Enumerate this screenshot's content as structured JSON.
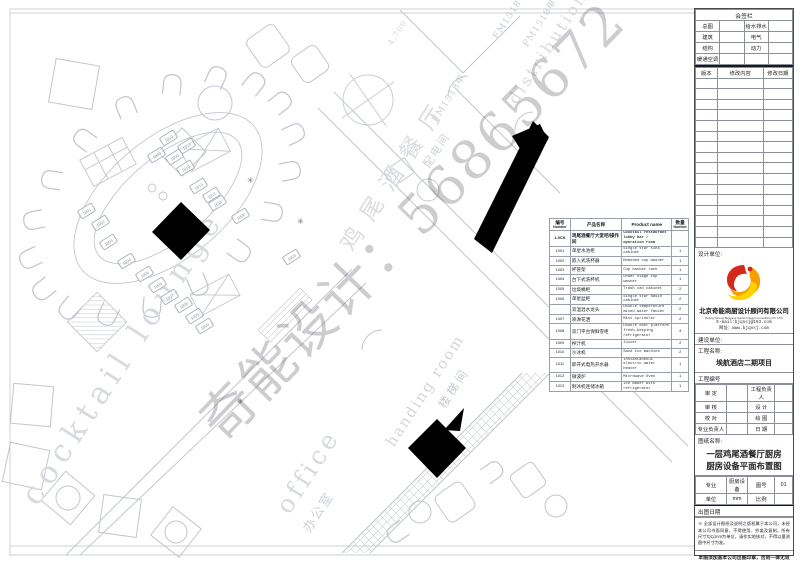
{
  "watermark": "奇能设计：56865672",
  "plan": {
    "texts": [
      {
        "id": "cocktail-lounge",
        "text": "cocktail lounge",
        "x": 14,
        "y": 492,
        "rot": -57,
        "size": 31,
        "ls": 7,
        "color": "#d7dade"
      },
      {
        "id": "lounge-cn",
        "text": "鸡尾酒餐厅",
        "x": 330,
        "y": 238,
        "rot": -57,
        "size": 23,
        "ls": 13,
        "color": "#dadce0"
      },
      {
        "id": "handing-room",
        "text": "handing room",
        "x": 382,
        "y": 440,
        "rot": -57,
        "size": 15,
        "ls": 2,
        "color": "#d3d6db"
      },
      {
        "id": "stair-cn",
        "text": "楼梯间",
        "x": 434,
        "y": 402,
        "rot": -57,
        "size": 12,
        "ls": 3,
        "color": "#c7ccd4"
      },
      {
        "id": "office-en",
        "text": "office",
        "x": 270,
        "y": 503,
        "rot": -57,
        "size": 25,
        "ls": 4,
        "color": "#d6d9dd"
      },
      {
        "id": "office-cn",
        "text": "办公室",
        "x": 297,
        "y": 525,
        "rot": -57,
        "size": 13,
        "ls": 2,
        "color": "#ced2d8"
      },
      {
        "id": "dist-cn",
        "text": "配电间",
        "x": 419,
        "y": 162,
        "rot": -57,
        "size": 11,
        "ls": 2,
        "color": "#ced2d8"
      },
      {
        "id": "dist-en",
        "text": "distribution",
        "x": 504,
        "y": 97,
        "rot": -57,
        "size": 16,
        "ls": 3,
        "color": "#d8dadf"
      },
      {
        "id": "door-tag-1",
        "text": "FM1518甲",
        "x": 428,
        "y": 117,
        "rot": -57,
        "size": 9,
        "ls": 1,
        "color": "#c9ced6"
      },
      {
        "id": "door-tag-2",
        "text": "FM1518甲",
        "x": 519,
        "y": 42,
        "rot": -57,
        "size": 9,
        "ls": 1,
        "color": "#c9ced6"
      },
      {
        "id": "door-tag-3",
        "text": "FM1518甲",
        "x": 489,
        "y": 34,
        "rot": -57,
        "size": 9,
        "ls": 1,
        "color": "#c9ced6"
      },
      {
        "id": "dim-4700",
        "text": "4,700",
        "x": 386,
        "y": 42,
        "rot": -57,
        "size": 8,
        "ls": 1,
        "color": "#d2d5da"
      }
    ],
    "tags": [
      {
        "n": "1010",
        "x": 160,
        "y": 133
      },
      {
        "n": "1013",
        "x": 178,
        "y": 141
      },
      {
        "n": "1009",
        "x": 148,
        "y": 150
      },
      {
        "n": "1009",
        "x": 166,
        "y": 152
      },
      {
        "n": "1010",
        "x": 177,
        "y": 163
      },
      {
        "n": "1013",
        "x": 190,
        "y": 181
      },
      {
        "n": "1012",
        "x": 203,
        "y": 190
      },
      {
        "n": "1011",
        "x": 209,
        "y": 198
      },
      {
        "n": "1008",
        "x": 232,
        "y": 211
      },
      {
        "n": "1009",
        "x": 283,
        "y": 252
      },
      {
        "n": "1001",
        "x": 78,
        "y": 206
      },
      {
        "n": "1002",
        "x": 92,
        "y": 218
      },
      {
        "n": "1003",
        "x": 100,
        "y": 237
      },
      {
        "n": "1004",
        "x": 118,
        "y": 256
      },
      {
        "n": "1005",
        "x": 136,
        "y": 269
      },
      {
        "n": "1006",
        "x": 149,
        "y": 280
      },
      {
        "n": "1007",
        "x": 161,
        "y": 292
      },
      {
        "n": "1008",
        "x": 175,
        "y": 300
      },
      {
        "n": "1009",
        "x": 186,
        "y": 311
      },
      {
        "n": "1009",
        "x": 196,
        "y": 321
      }
    ],
    "stars": [
      {
        "x": 247,
        "y": 176
      },
      {
        "x": 297,
        "y": 217
      },
      {
        "x": 237,
        "y": 397
      }
    ]
  },
  "equipment": {
    "headers": {
      "id_cn": "编号",
      "id_en": "Number",
      "name_cn": "产品名称",
      "name_en": "Product name",
      "qty_cn": "数量",
      "qty_en": "Number"
    },
    "rows": [
      {
        "id": "1-0CK",
        "cn": "鸡尾酒餐厅大堂吧/操作间",
        "en": "Cocktail restaurant lobby bar / operation room",
        "qty": "",
        "section": true
      },
      {
        "id": "1001",
        "cn": "单星水池柜",
        "en": "Single star sink cabinet",
        "qty": "1"
      },
      {
        "id": "1002",
        "cn": "嵌入式洗杯器",
        "en": "Embeded cup washer",
        "qty": "1"
      },
      {
        "id": "1003",
        "cn": "杯筐架",
        "en": "Cup basket rack",
        "qty": "1"
      },
      {
        "id": "1004",
        "cn": "台下式洗杯机",
        "en": "Under stage cup washer",
        "qty": "1"
      },
      {
        "id": "1005",
        "cn": "垃圾桶柜",
        "en": "Trash can cabinet",
        "qty": "2"
      },
      {
        "id": "1006",
        "cn": "单星盆柜",
        "en": "Single star basin cabinet",
        "qty": "2"
      },
      {
        "id": "",
        "cn": "双温混水龙头",
        "en": "Double temperature mixed water faucet",
        "qty": "2"
      },
      {
        "id": "1007",
        "cn": "喷淋花洒",
        "en": "Mist sprinkler",
        "qty": "2"
      },
      {
        "id": "1008",
        "cn": "双门平台保鲜雪柜",
        "en": "Double door platform fresh-keeping refrigerator",
        "qty": "4"
      },
      {
        "id": "1009",
        "cn": "榨汁机",
        "en": "Juicer",
        "qty": "2"
      },
      {
        "id": "1010",
        "cn": "沙冰机",
        "en": "Sand ice machine",
        "qty": "2"
      },
      {
        "id": "1011",
        "cn": "即开式电热开水器",
        "en": "Instantaneous electric water heater",
        "qty": "1"
      },
      {
        "id": "1012",
        "cn": "微波炉",
        "en": "Microwave Oven",
        "qty": "1"
      },
      {
        "id": "1013",
        "cn": "制冰机连储冰箱",
        "en": "Ice maker with refrigerator",
        "qty": "1"
      }
    ]
  },
  "titleblock": {
    "sign_title": "会签栏",
    "sign_rows": [
      [
        "总图",
        "",
        "给水排水",
        ""
      ],
      [
        "建筑",
        "",
        "电气",
        ""
      ],
      [
        "结构",
        "",
        "动力",
        ""
      ],
      [
        "暖通空调",
        "",
        "",
        ""
      ]
    ],
    "revision_headers": [
      "版本",
      "修改内容",
      "修改日期"
    ],
    "design_unit_label": "设计单位:",
    "company": {
      "name_cn": "北京奇能商厨设计顾问有限公司",
      "name_en": "Beijing Qineng Business Kitchen Design Consulting CO.,LTD",
      "email": "E-mail:bjqnsj@163.com",
      "web": "网址：www.bjqnsj.com"
    },
    "build_unit_label": "建设单位:",
    "project_label": "工程名称:",
    "project_name": "埃航酒店二期项目",
    "project_no_label": "工程编号",
    "grid_rows": [
      [
        "审  定",
        "",
        "工程负责人",
        ""
      ],
      [
        "审  核",
        "",
        "设  计",
        ""
      ],
      [
        "校  对",
        "",
        "绘  图",
        ""
      ],
      [
        "专业负责人",
        "",
        "日  期",
        ""
      ]
    ],
    "drawing_label": "图纸名称:",
    "drawing_name_1": "一层鸡尾酒餐厅厨房",
    "drawing_name_2": "厨房设备平面布置图",
    "meta_rows": [
      [
        "专业",
        "厨房设备",
        "图号",
        "01"
      ],
      [
        "单位",
        "mm",
        "比例",
        ""
      ]
    ],
    "date_label": "出图日期",
    "note": "※ 全部设计图纸及说明之版权属于本公司，未经本公司书面同意，不得使用、抄袭及复制。所有尺寸均以mm为单位，请作实地核对，不得以量测图中尺寸为准。",
    "stamp": "本图须加盖本公司出图印章，否则一律无效"
  }
}
